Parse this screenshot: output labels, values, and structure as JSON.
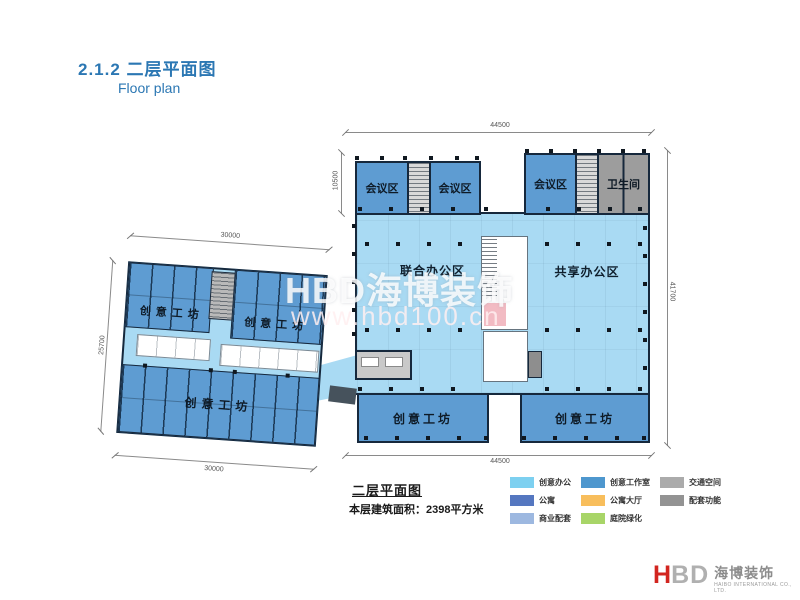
{
  "page": {
    "title": "2.1.2 二层平面图",
    "subtitle": "Floor plan"
  },
  "plan": {
    "rooms": {
      "meeting_1": "会议区",
      "meeting_2": "会议区",
      "meeting_3": "会议区",
      "restroom": "卫生间",
      "joint_office": "联合办公区",
      "shared_office": "共享办公区",
      "workshop_bottom_left": "创意工坊",
      "workshop_bottom_right": "创意工坊",
      "annex_workshop_top_left": "创意工坊",
      "annex_workshop_top_right": "创意工坊",
      "annex_workshop_bottom": "创意工坊"
    },
    "dimensions": {
      "main_top": "44500",
      "main_bottom": "44500",
      "main_right": "41700",
      "main_left_upper": "10500",
      "annex_top": "30000",
      "annex_bottom": "30000",
      "annex_left": "25700"
    }
  },
  "legend": {
    "title": "二层平面图",
    "area_label": "本层建筑面积：2398平方米",
    "items": [
      {
        "label": "创意办公",
        "color": "#7DD0F0"
      },
      {
        "label": "创意工作室",
        "color": "#4E97CE"
      },
      {
        "label": "交通空间",
        "color": "#ABABAB"
      },
      {
        "label": "公寓",
        "color": "#5577C0"
      },
      {
        "label": "公寓大厅",
        "color": "#F8BE5C"
      },
      {
        "label": "配套功能",
        "color": "#939393"
      },
      {
        "label": "商业配套",
        "color": "#9DB8E0"
      },
      {
        "label": "庭院绿化",
        "color": "#A8D568"
      }
    ]
  },
  "watermark": {
    "brand": "HBD海博装饰",
    "url": "www.hbd100.cn"
  },
  "logo": {
    "letter_h": "H",
    "letters_bd": "BD",
    "company_cn": "海博装饰",
    "company_en": "HAIBO INTERNATIONAL CO., LTD."
  },
  "colors": {
    "title_blue": "#2B77B3",
    "wall": "#16283C",
    "open_office_fill": "#A9DAF3",
    "workshop_fill": "#5E9CD2",
    "service_gray": "#9D9D9D",
    "logo_red": "#D2251F"
  }
}
